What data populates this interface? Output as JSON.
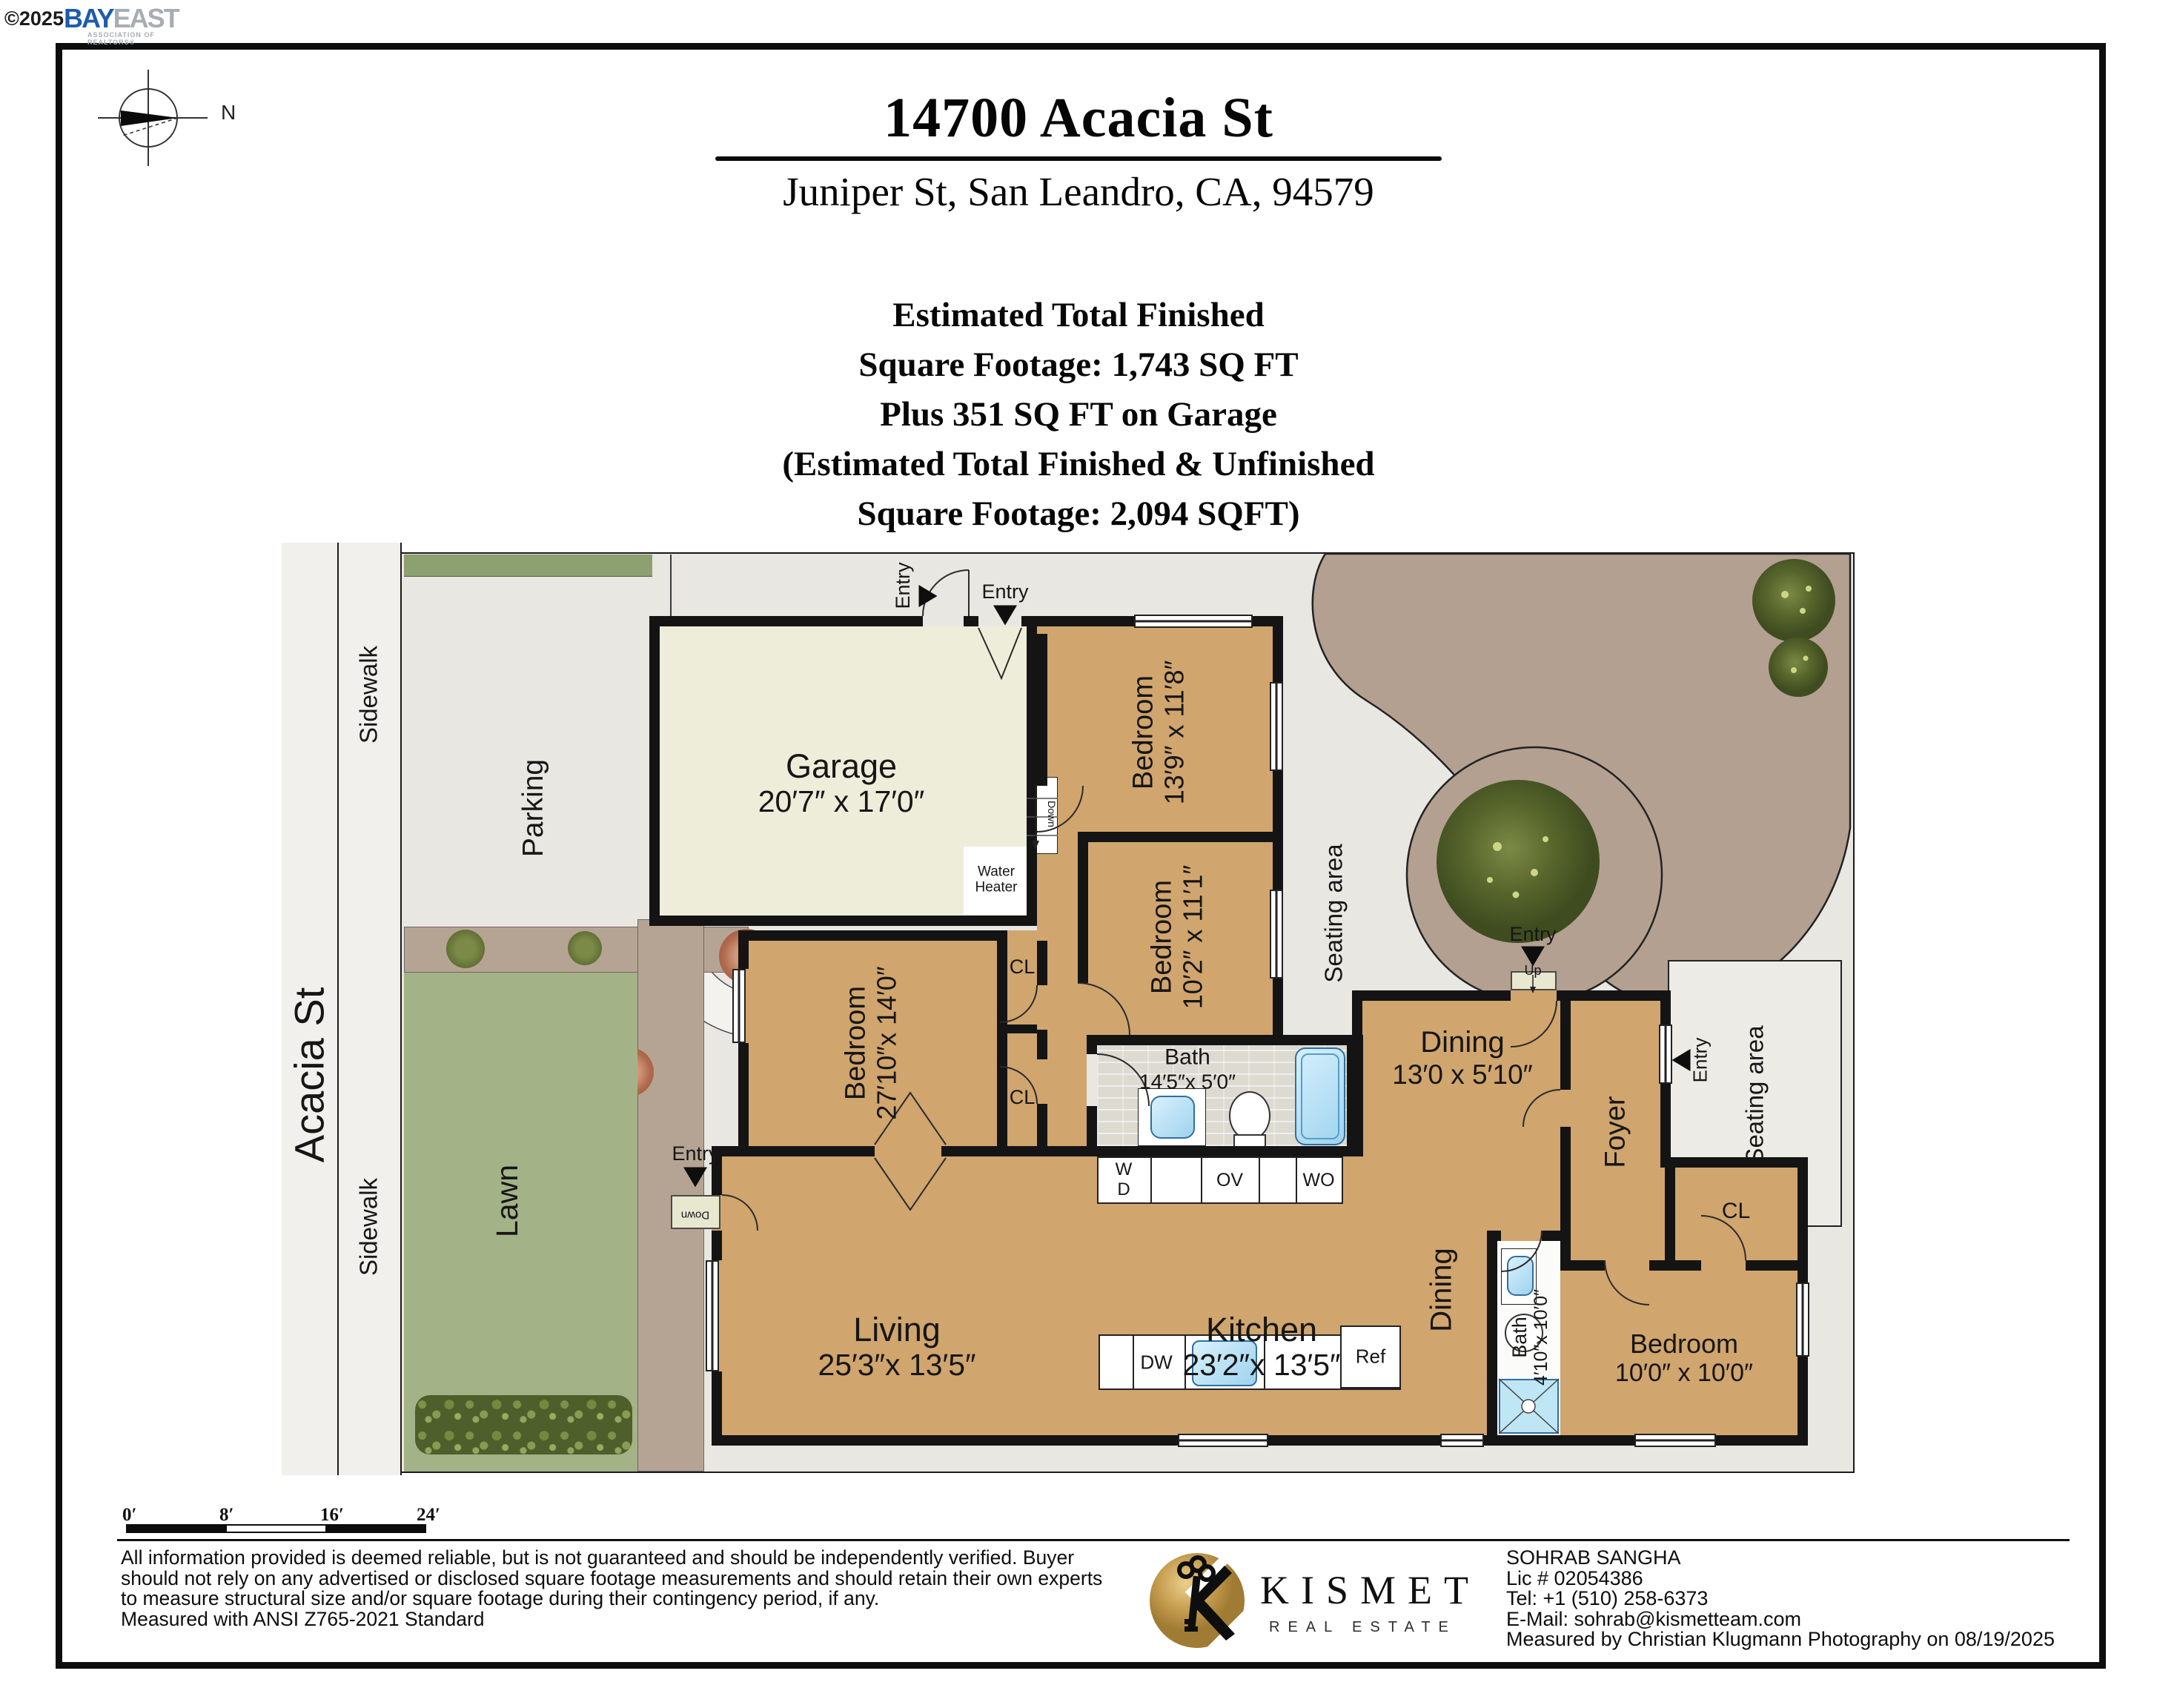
{
  "branding": {
    "copyright": "©2025",
    "bay": "BAY",
    "east": "EAST",
    "assoc": "ASSOCIATION OF REALTORS®"
  },
  "compass": {
    "north": "N"
  },
  "header": {
    "title": "14700 Acacia St",
    "address": "Juniper St, San Leandro, CA, 94579",
    "sqft": [
      "Estimated Total Finished",
      "Square Footage: 1,743 SQ FT",
      "Plus 351 SQ FT on Garage",
      "(Estimated Total Finished & Unfinished",
      "Square Footage: 2,094 SQFT)"
    ]
  },
  "site": {
    "street": "Acacia St",
    "sidewalk": "Sidewalk",
    "parking": "Parking",
    "lawn": "Lawn",
    "seating": "Seating area",
    "entry": "Entry",
    "up": "Up",
    "down": "Down"
  },
  "rooms": {
    "garage": {
      "name": "Garage",
      "dims": "20′7″ x 17′0″"
    },
    "bedroom_ne": {
      "name": "Bedroom",
      "dims": "13′9″ x 11′8″"
    },
    "bedroom_e": {
      "name": "Bedroom",
      "dims": "10′2″ x 11′1″"
    },
    "bedroom_w": {
      "name": "Bedroom",
      "dims": "27′10″x 14′0″"
    },
    "bedroom_se": {
      "name": "Bedroom",
      "dims": "10′0″ x 10′0″"
    },
    "bath_main": {
      "name": "Bath",
      "dims": "14′5″x 5′0″"
    },
    "bath_small": {
      "name": "Bath",
      "dims": "4′10″x 10′0″"
    },
    "living": {
      "name": "Living",
      "dims": "25′3″x 13′5″"
    },
    "kitchen": {
      "name": "Kitchen",
      "dims": "23′2″x 13′5″"
    },
    "dining": {
      "name": "Dining",
      "dims": "13′0 x 5′10″"
    },
    "dining_2": {
      "name": "Dining"
    },
    "foyer": {
      "name": "Foyer"
    },
    "closet": "CL"
  },
  "fixtures": {
    "water_heater": "Water Heater",
    "washer_w": "W",
    "washer_d": "D",
    "oven": "OV",
    "wall_oven": "WO",
    "dishwasher": "DW",
    "fridge": "Ref"
  },
  "scale_bar": {
    "labels": [
      "0′",
      "8′",
      "16′",
      "24′"
    ]
  },
  "footer": {
    "disclaimer": "All information provided is deemed reliable, but is not guaranteed and should be independently verified. Buyer should not rely on any advertised or disclosed square footage measurements and should retain their own experts to measure structural size and/or square footage during their contingency period, if any.",
    "standard": "Measured with ANSI Z765-2021 Standard",
    "brand": {
      "name": "KISMET",
      "tagline": "REAL ESTATE"
    },
    "agent": {
      "name": "SOHRAB SANGHA",
      "license": "Lic # 02054386",
      "phone": "Tel: +1 (510) 258-6373",
      "email": "E-Mail: sohrab@kismetteam.com",
      "measured_by": "Measured by Christian Klugmann Photography on 08/19/2025"
    }
  },
  "colors": {
    "room_tan": "#d0a56e",
    "garage_cream": "#eeedda",
    "lawn_green": "#a4b287",
    "path_brown": "#b5a494",
    "water_blue": "#a9d9f1",
    "wall_black": "#141414",
    "brand_gold": "#c69c4e"
  }
}
